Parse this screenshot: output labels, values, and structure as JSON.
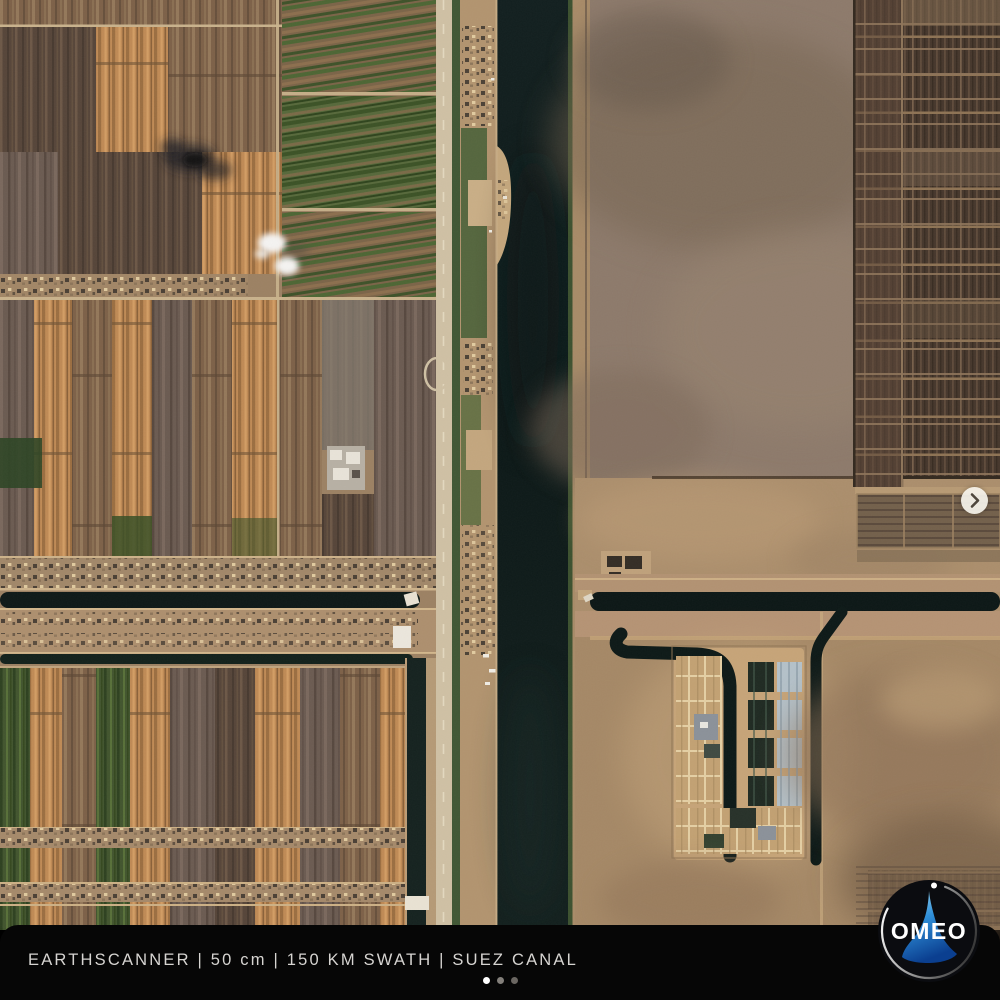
{
  "window": {
    "width": 1000,
    "height": 1000
  },
  "caption_bar": {
    "text": "EARTHSCANNER | 50 cm | 150 KM SWATH | SUEZ CANAL",
    "segments": [
      "EARTHSCANNER",
      "50 cm",
      "150 KM SWATH",
      "SUEZ CANAL"
    ],
    "separator": "|",
    "background": "#060606",
    "text_color": "#d6d4d1"
  },
  "carousel": {
    "dot_count": 3,
    "active_dot_index": 0,
    "active_color": "#ffffff",
    "inactive_color": "#6e6a66",
    "next_button": {
      "icon": "chevron-right",
      "background": "#f2efe8",
      "icon_color": "#4e463c"
    }
  },
  "logo": {
    "text": "OMEO",
    "text_color": "#ffffff",
    "circle_color": "#0b0c10",
    "accent_blue": "#2a7fd4"
  },
  "satellite_image": {
    "description": "Overhead satellite view of the Suez Canal: striped irrigated farmland west of the canal, dark canal water running vertically, desert with dark aquaculture pond grids and a water treatment facility east of the canal, smoke plume and small clouds over fields.",
    "features": [
      "farmland-strips-west",
      "suez-canal-water",
      "east-desert",
      "aquaculture-pond-grid",
      "water-treatment-facility",
      "irrigation-canals",
      "smoke-plume",
      "clouds",
      "ferry-crossing"
    ],
    "palette": {
      "water": "#0e1a19",
      "farmland_orange": "#bf8a55",
      "farmland_brown": "#7d6148",
      "farmland_green": "#42552e",
      "desert_upper": "#8d7a6b",
      "desert_sand": "#ab8e6c",
      "pond_grid": "#46372c",
      "facility_basin": "#c2a173",
      "clarifier_blue": "#b4c1c9"
    }
  }
}
